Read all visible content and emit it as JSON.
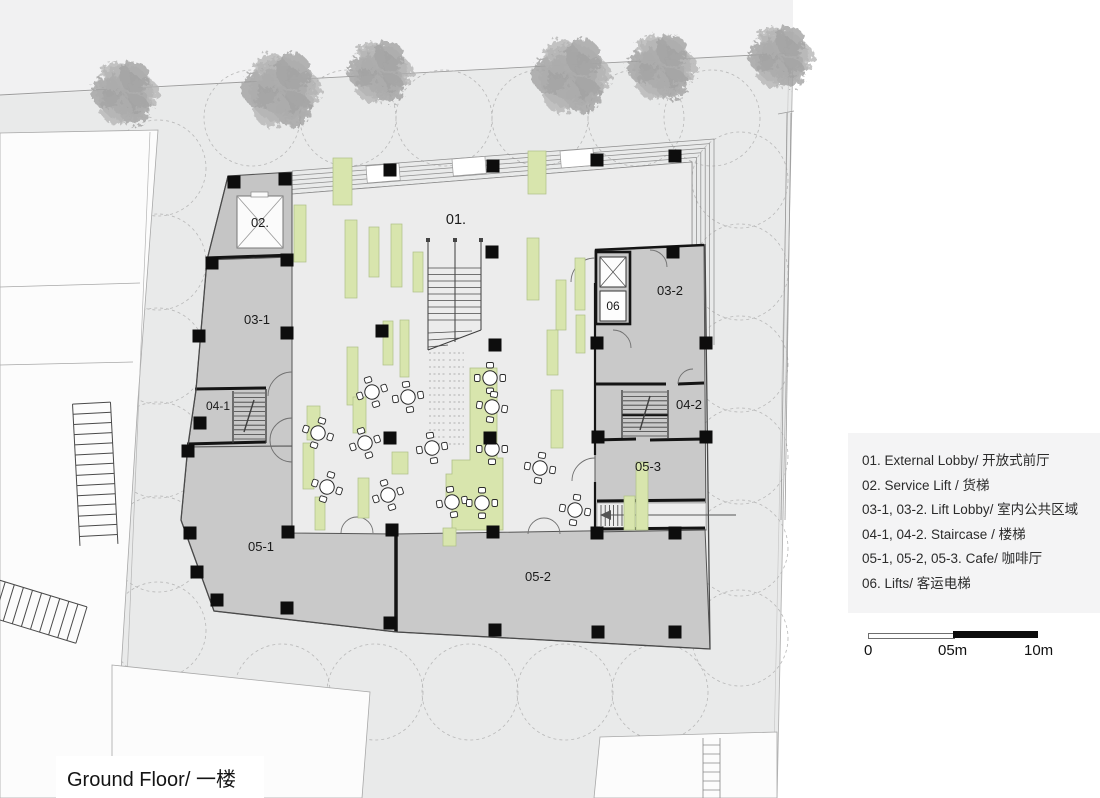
{
  "title": "Ground Floor/ 一楼",
  "plan_labels": {
    "room01": "01.",
    "room02": "02.",
    "room03_1": "03-1",
    "room03_2": "03-2",
    "room04_1": "04-1",
    "room04_2": "04-2",
    "room05_1": "05-1",
    "room05_2": "05-2",
    "room05_3": "05-3",
    "room06": "06"
  },
  "legend": {
    "items": [
      "01. External Lobby/ 开放式前厅",
      "02. Service Lift / 货梯",
      "03-1, 03-2. Lift Lobby/ 室内公共区域",
      "04-1, 04-2. Staircase / 楼梯",
      "05-1, 05-2, 05-3. Cafe/ 咖啡厅",
      "06. Lifts/ 客运电梯"
    ]
  },
  "scale_bar": {
    "label_start": "0",
    "label_mid": "05m",
    "label_end": "10m"
  },
  "colors": {
    "site_ground": "#e9eaea",
    "street_band": "#f1f1f2",
    "room_gray": "#c9c9c9",
    "lobby_floor": "#ececec",
    "bench_green": "#d8e5ad",
    "wall_black": "#141414",
    "legend_bg": "#f4f4f5"
  }
}
